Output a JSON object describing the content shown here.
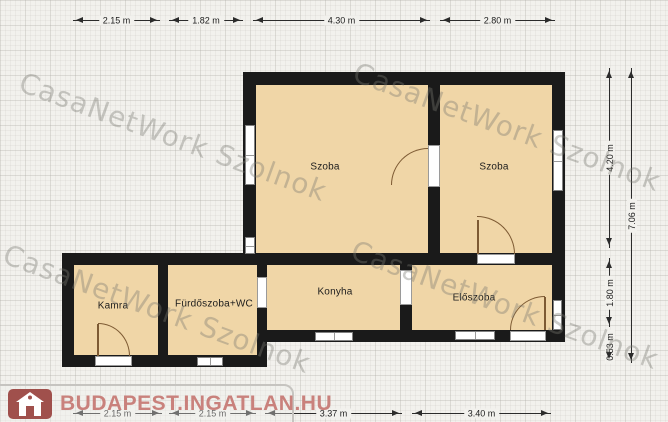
{
  "watermark": {
    "text": "CasaNetWork Szolnok"
  },
  "logo": {
    "text": "BUDAPEST.INGATLAN.HU",
    "icon": "house-icon",
    "icon_color": "#a0504c",
    "text_color": "#c9817c"
  },
  "rooms": {
    "szoba_left": {
      "label": "Szoba"
    },
    "szoba_right": {
      "label": "Szoba"
    },
    "kamra": {
      "label": "Kamra"
    },
    "furdoszoba": {
      "label": "Fürdőszoba+WC"
    },
    "konyha": {
      "label": "Konyha"
    },
    "eloszoba": {
      "label": "Előszoba"
    }
  },
  "dimensions": {
    "top": [
      {
        "label": "2.15 m"
      },
      {
        "label": "1.82 m"
      },
      {
        "label": "4.30 m"
      },
      {
        "label": "2.80 m"
      }
    ],
    "bottom": [
      {
        "label": "2.15 m"
      },
      {
        "label": "2.15 m"
      },
      {
        "label": "3.37 m"
      },
      {
        "label": "3.40 m"
      }
    ],
    "right_inner": [
      {
        "label": "4.20 m"
      },
      {
        "label": "1.80 m"
      },
      {
        "label": "0.53 m"
      }
    ],
    "right_outer": [
      {
        "label": "7.06 m"
      }
    ]
  },
  "colors": {
    "floor": "#f0d6a7",
    "wall": "#1a1a1a",
    "background": "#f2f1ed",
    "watermark": "#7a7872",
    "logo_accent": "#a0504c"
  }
}
